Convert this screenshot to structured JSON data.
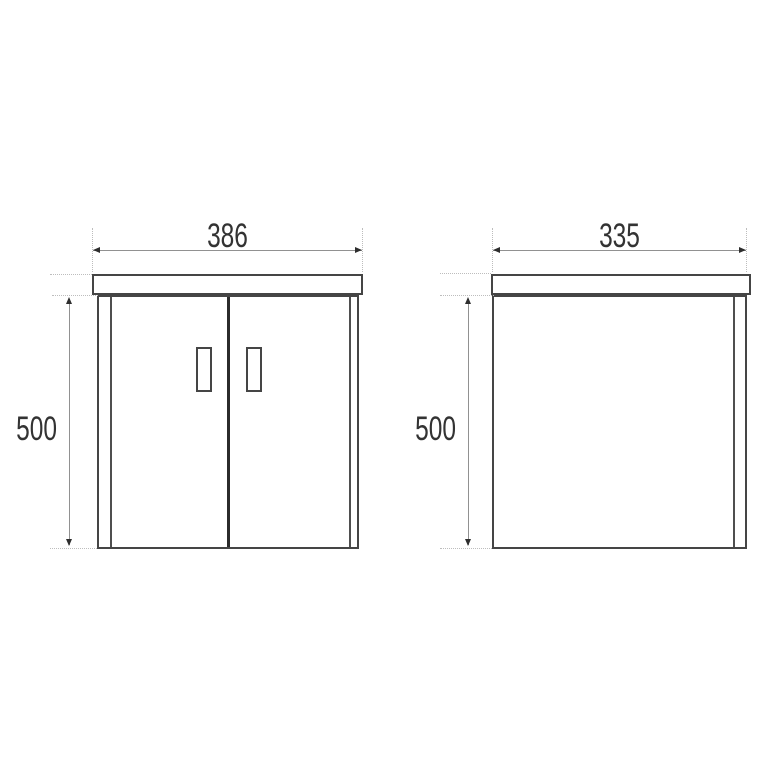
{
  "colors": {
    "background": "#ffffff",
    "outline": "#454545",
    "inner_line": "#4f4f4f",
    "divider": "#2b2b2b",
    "dimension_line": "#919191",
    "extension_line": "#bdbdbd",
    "arrow": "#2e2e2e",
    "text": "#333333"
  },
  "front_view": {
    "width_label": "386",
    "height_label": "500"
  },
  "side_view": {
    "depth_label": "335",
    "height_label": "500"
  }
}
